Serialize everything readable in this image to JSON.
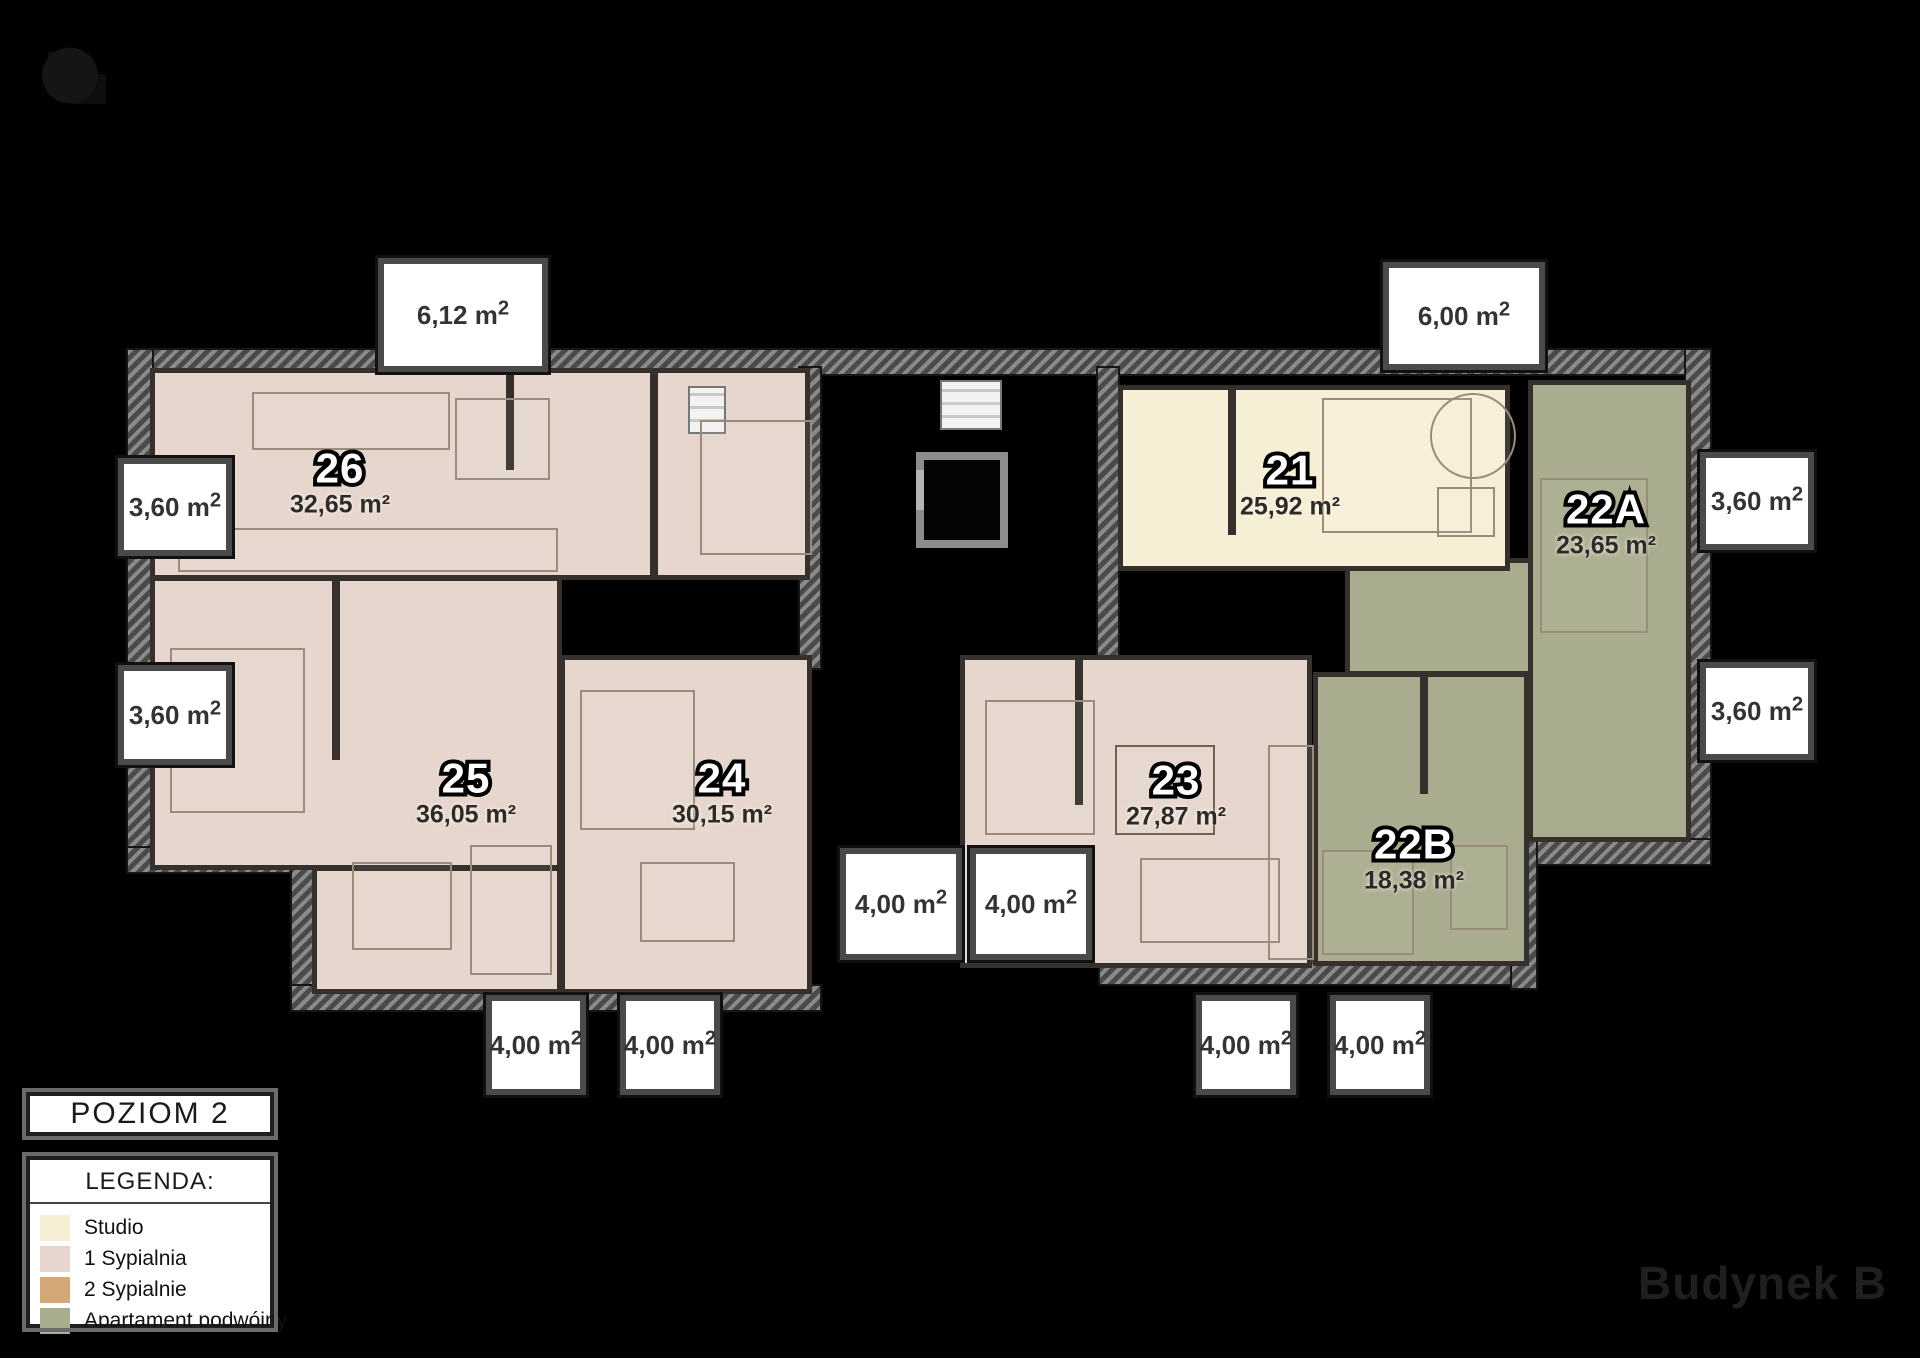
{
  "title": "POZIOM 2",
  "legend": {
    "heading": "LEGENDA:",
    "items": [
      {
        "label": "Studio",
        "color": "#f7eed6"
      },
      {
        "label": "1 Sypialnia",
        "color": "#e6d6cd"
      },
      {
        "label": "2 Sypialnie",
        "color": "#d2a878"
      },
      {
        "label": "Apartament podwójny",
        "color": "#a9ac8e"
      }
    ]
  },
  "building_label": "Budynek B",
  "apartments": [
    {
      "id": "26",
      "area": "32,65 m²",
      "type": "1 Sypialnia"
    },
    {
      "id": "25",
      "area": "36,05 m²",
      "type": "1 Sypialnia"
    },
    {
      "id": "24",
      "area": "30,15 m²",
      "type": "1 Sypialnia"
    },
    {
      "id": "23",
      "area": "27,87 m²",
      "type": "1 Sypialnia"
    },
    {
      "id": "22B",
      "area": "18,38 m²",
      "type": "Apartament podwójny"
    },
    {
      "id": "22A",
      "area": "23,65 m²",
      "type": "Apartament podwójny"
    },
    {
      "id": "21",
      "area": "25,92 m²",
      "type": "Studio"
    }
  ],
  "balconies": [
    {
      "area": "6,12 m²"
    },
    {
      "area": "6,00 m²"
    },
    {
      "area": "3,60 m²"
    },
    {
      "area": "3,60 m²"
    },
    {
      "area": "3,60 m²"
    },
    {
      "area": "3,60 m²"
    },
    {
      "area": "4,00 m²"
    },
    {
      "area": "4,00 m²"
    },
    {
      "area": "4,00 m²"
    },
    {
      "area": "4,00 m²"
    },
    {
      "area": "4,00 m²"
    },
    {
      "area": "4,00 m²"
    }
  ]
}
